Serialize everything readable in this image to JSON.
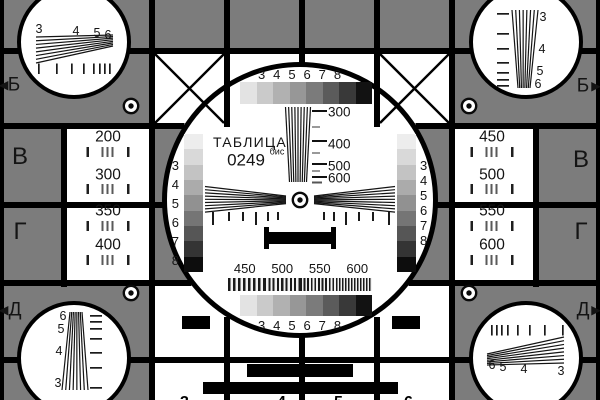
{
  "colors": {
    "background": "#7c7c7c",
    "grid": "#000000",
    "text": "#141414",
    "steps8": [
      "#e3e3e3",
      "#cacaca",
      "#b1b1b1",
      "#979797",
      "#7b7b7b",
      "#5b5b5b",
      "#393939",
      "#121212"
    ],
    "steps9": [
      "#ededed",
      "#d9d9d9",
      "#c3c3c3",
      "#ababab",
      "#919191",
      "#757575",
      "#565656",
      "#343434",
      "#0d0d0d"
    ]
  },
  "title": {
    "word": "ТАБЛИЦА",
    "number": "0249",
    "sup": "бис"
  },
  "scales": {
    "top": [
      "3",
      "4",
      "5",
      "6",
      "7",
      "8"
    ],
    "bottom": [
      "3",
      "4",
      "5",
      "6",
      "7",
      "8"
    ]
  },
  "bars": {
    "left": [
      "3",
      "4",
      "5",
      "6",
      "7",
      "8"
    ],
    "right": [
      "3",
      "4",
      "5",
      "6",
      "7",
      "8"
    ]
  },
  "freq": {
    "labels": [
      "300",
      "400",
      "500",
      "600"
    ]
  },
  "burst": {
    "labels": [
      "450",
      "500",
      "550",
      "600"
    ]
  },
  "panels": {
    "left": [
      "200",
      "300",
      "350",
      "400"
    ],
    "right": [
      "450",
      "500",
      "550",
      "600"
    ]
  },
  "corners": {
    "top_left": [
      "3",
      "4",
      "5",
      "6"
    ],
    "top_right": [
      "3",
      "4",
      "5",
      "6"
    ],
    "bottom_left": [
      "6",
      "5",
      "4",
      "3"
    ],
    "bottom_right": [
      "6",
      "5",
      "4",
      "3"
    ]
  },
  "edges": {
    "left": [
      "Б",
      "В",
      "Г",
      "Д"
    ],
    "right": [
      "Б",
      "В",
      "Г",
      "Д"
    ],
    "arrow_left": "◀",
    "arrow_right": "▶"
  },
  "tips": {
    "top": [
      "3",
      "4",
      "5",
      "6"
    ],
    "bottom": [
      "3",
      "4",
      "5",
      "6"
    ]
  }
}
